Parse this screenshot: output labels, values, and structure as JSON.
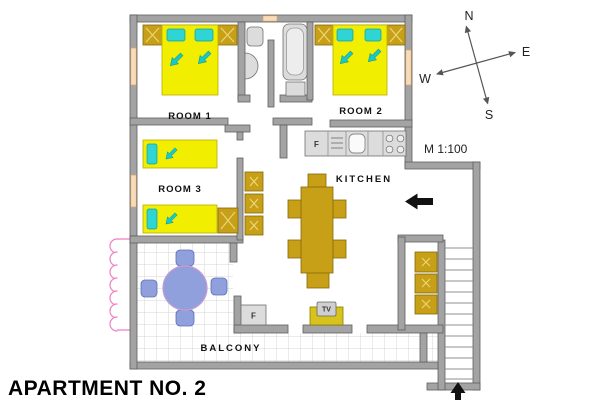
{
  "title": "APARTMENT NO. 2",
  "scale": "M 1:100",
  "compass": {
    "n": "N",
    "e": "E",
    "s": "S",
    "w": "W"
  },
  "labels": {
    "room1": "ROOM 1",
    "room2": "ROOM 2",
    "room3": "ROOM 3",
    "kitchen": "KITCHEN",
    "balcony": "BALCONY",
    "fridge": "F",
    "freezer": "F",
    "tv": "TV"
  },
  "colors": {
    "wall": "#a3a3a3",
    "furniture_wood": "#c7a017",
    "bed_yellow": "#f2ee00",
    "pillow_cyan": "#2fd4d4",
    "balcony_furniture_blue": "#8fa0dd",
    "window_peach": "#f7dcbb",
    "awning_pink": "#f07fc1",
    "arrow_black": "#111111"
  }
}
